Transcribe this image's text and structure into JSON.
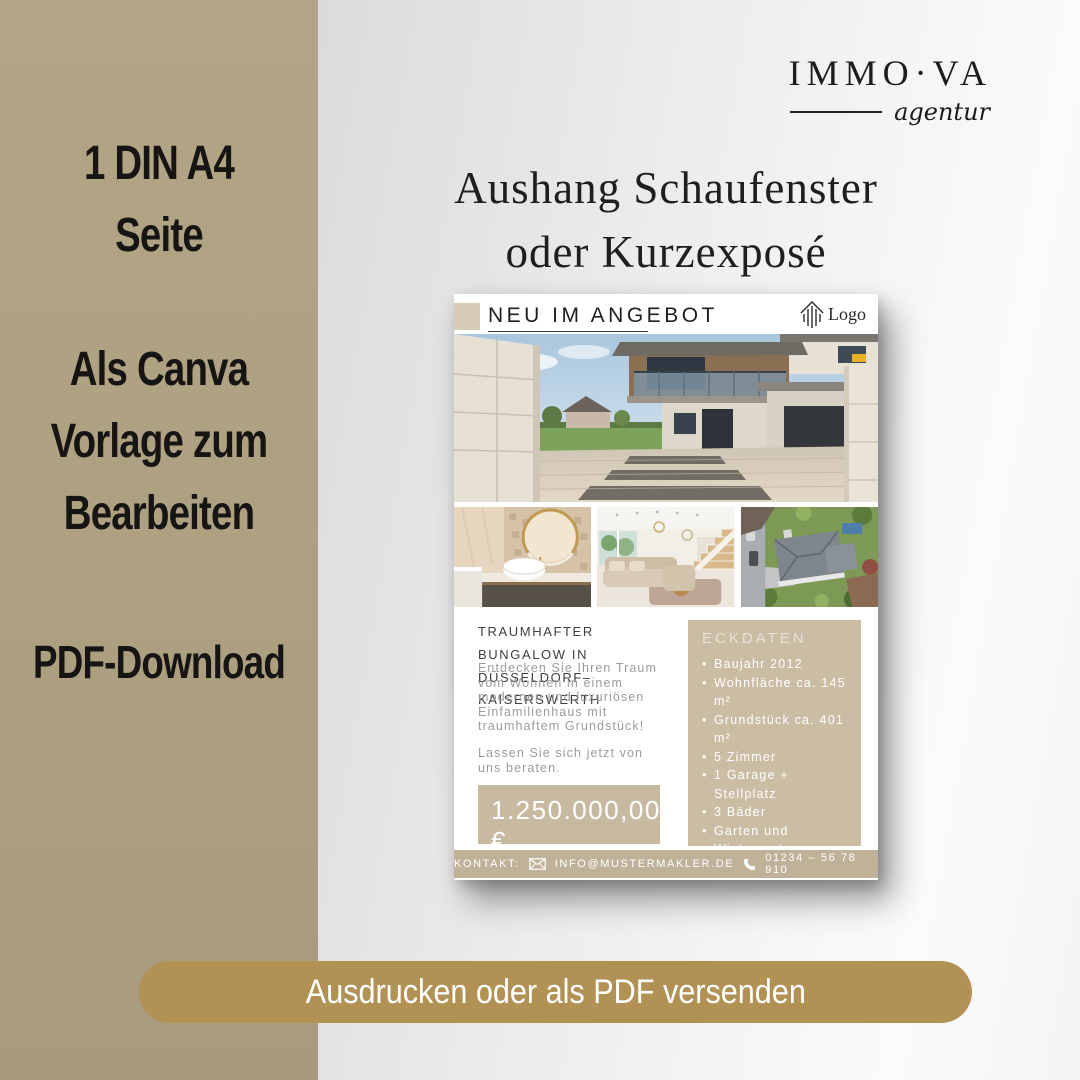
{
  "left_panel": {
    "features": [
      {
        "lines": [
          "1 DIN A4",
          "Seite"
        ]
      },
      {
        "lines": [
          "Als Canva",
          "Vorlage zum",
          "Bearbeiten"
        ]
      },
      {
        "lines": [
          "PDF-Download"
        ]
      }
    ]
  },
  "brand": {
    "name": "IMMO·VA",
    "tagline": "agentur"
  },
  "headline": {
    "line1": "Aushang Schaufenster",
    "line2": "oder Kurzexposé"
  },
  "flyer": {
    "header": {
      "title": "NEU IM ANGEBOT",
      "logo_label": "Logo"
    },
    "listing": {
      "title_line1": "TRAUMHAFTER BUNGALOW IN",
      "title_line2": "DÜSSELDORF–KAISERSWERTH",
      "description": "Entdecken Sie Ihren Traum vom Wohnen in einem modernen und luxuriösen Einfamilienhaus mit traumhaftem Grundstück!",
      "cta": "Lassen Sie sich jetzt von uns beraten.",
      "price": "1.250.000,00 €",
      "price_note": "zzgl. 3,57 % Provision"
    },
    "eckdaten": {
      "title": "ECKDATEN",
      "items": [
        "Baujahr 2012",
        "Wohnfläche ca. 145 m²",
        "Grundstück ca. 401 m²",
        "5 Zimmer",
        "1 Garage + Stellplatz",
        "3 Bäder",
        "Garten und Wintergarten",
        "Gaszentralheizung"
      ]
    },
    "contact": {
      "label": "KONTAKT:",
      "email": "INFO@MUSTERMAKLER.DE",
      "phone": "01234 – 56 78 910"
    }
  },
  "cta_button": {
    "label": "Ausdrucken oder als PDF versenden"
  },
  "colors": {
    "sidebar_tan": "#ada080",
    "accent_gold": "#b29254",
    "flyer_beige": "#c8baa1",
    "flyer_beige_light": "#d8ccb8",
    "footer_beige": "#c0b298"
  }
}
